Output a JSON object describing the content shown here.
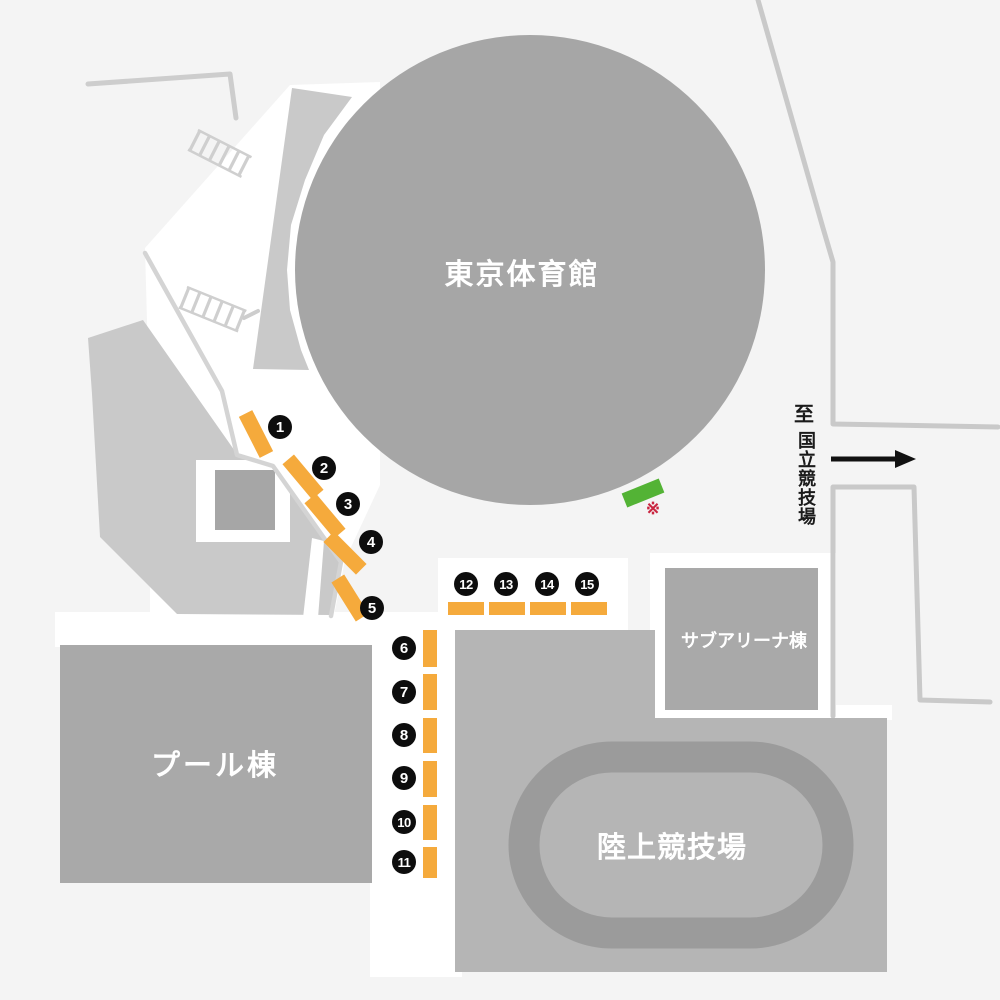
{
  "map": {
    "buildings": [
      {
        "id": "gymnasium",
        "label": "東京体育館"
      },
      {
        "id": "pool",
        "label": "プール棟"
      },
      {
        "id": "sub-arena",
        "label": "サブアリーナ棟"
      },
      {
        "id": "athletics-field",
        "label": "陸上競技場"
      }
    ],
    "direction_sign": {
      "prefix": "至",
      "destination": "国立競技場"
    },
    "note": {
      "symbol": "※"
    },
    "gates": [
      {
        "label": "1"
      },
      {
        "label": "2"
      },
      {
        "label": "3"
      },
      {
        "label": "4"
      },
      {
        "label": "5"
      },
      {
        "label": "6"
      },
      {
        "label": "7"
      },
      {
        "label": "8"
      },
      {
        "label": "9"
      },
      {
        "label": "10"
      },
      {
        "label": "11"
      },
      {
        "label": "12"
      },
      {
        "label": "13"
      },
      {
        "label": "14"
      },
      {
        "label": "15"
      }
    ],
    "icons": {
      "direction_arrow": "arrow-right"
    },
    "colors": {
      "background": "#f4f4f4",
      "walkway_white": "#ffffff",
      "path_line": "#cdcdcd",
      "building_gray": "#a9a9a9",
      "plaza_light_gray": "#c9c9c9",
      "field_block_gray": "#b5b5b5",
      "track_ring_gray": "#9b9b9b",
      "gate_marker_orange": "#f5aa3c",
      "special_marker_green": "#53b335",
      "note_red": "#c9243f",
      "badge_black": "#0d0d0d",
      "label_white": "#ffffff"
    }
  }
}
